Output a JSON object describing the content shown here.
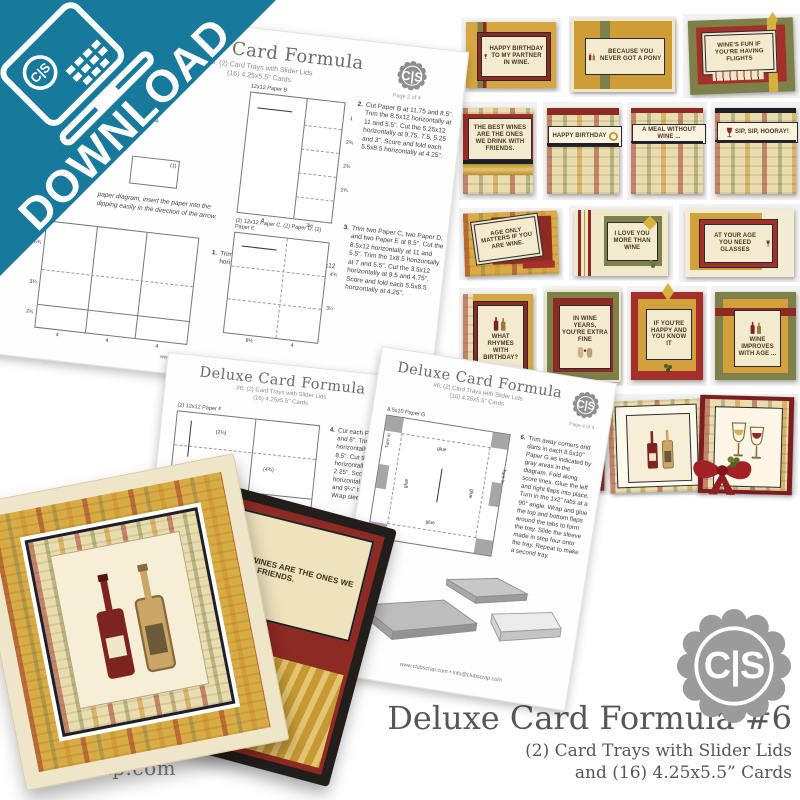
{
  "brand": {
    "badge_label": "C|S",
    "site": "clubscrap.com"
  },
  "banner": {
    "label": "DOWNLOAD"
  },
  "product": {
    "title": "Deluxe Card Formula #6",
    "subtitle_line1": "(2) Card Trays with Slider Lids",
    "subtitle_line2": "and (16) 4.25x5.5” Cards"
  },
  "colors": {
    "teal": "#17799C",
    "gold": "#D2A13C",
    "olive": "#7D8049",
    "dark_red": "#9C2D26",
    "cream": "#F2E8CB",
    "badge_gray": "#9B9B9B",
    "text_gray": "#58595B"
  },
  "icons": [
    "laptop-download-icon",
    "cs-seal-icon",
    "wine-glass-icon",
    "wine-bottles-icon",
    "gold-leaf-icon",
    "grapes-icon",
    "ribbon-bow-icon"
  ],
  "sheets": [
    {
      "title": "Deluxe Card Formula",
      "subtitle": "#6: (2) Card Trays with Slider Lids",
      "subtitle2": "(16) 4.25x5.5\" Cards",
      "page": "Page 2 of 4",
      "supplies_fragment1": "G.",
      "supplies_fragment2": ") A2 Envelopes.",
      "note_line1": "paper diagram, insert the paper into the",
      "note_line2": "dipping easily in the direction of the arrow.",
      "inset_label": "(1)",
      "diagrams": {
        "paper_a": {
          "left_ticks": [
            "5¾",
            "3¾",
            "2¾"
          ],
          "bottom_ticks": [
            "4",
            "4",
            "4"
          ]
        },
        "paper_b": {
          "label": "12x12 Paper B",
          "right_ticks": [
            "1",
            "2¾",
            "2¾",
            "2¾"
          ],
          "bottom_ticks": [
            "8",
            "3½"
          ]
        },
        "paper_cde": {
          "label": "(2) 12x12 Paper C, (2) Paper D, (2) Paper E",
          "right_ticks": [
            "4¾",
            "3¼"
          ],
          "bottom_ticks": [
            "8½",
            "4"
          ]
        }
      },
      "steps": [
        {
          "num": "1.",
          "text": "Trim Paper A at 8 and 4\". Cut each 4x12 horizontally at 10.5 and 5.25\"."
        },
        {
          "num": "2.",
          "text": "Cut Paper B at 11.75 and 8.5\". Trim the 8.5x12 horizontally at 11 and 5.5\". Cut the 5.25x12 horizontally at 9.75, 7.5, 5.25 and 3\". Score and fold each 5.5x8.5 horizontally at 4.25\"."
        },
        {
          "num": "3.",
          "text": "Trim two Paper C, two Paper D, and two Paper E at 8.5\". Cut the 8.5x12 horizontally at 11 and 5.5\". Trim the 1x8.5 horizontally at 7 and 5.5\". Cut the 3.5x12 horizontally at 9.5 and 4.75\". Score and fold each 5.5x8.5 horizontally at 4.25\"."
        }
      ],
      "footer": "www.clubscrap.com • info@clubscrap.com"
    },
    {
      "title": "Deluxe Card Formula",
      "subtitle": "#6: (2) Card Trays with Slider Lids",
      "subtitle2": "(16) 4.25x5.5\" Cards",
      "page": "Page 3 of 4",
      "diagrams": {
        "paper_f": {
          "label": "(2) 12x12 Paper F",
          "t1": "(2¾)",
          "t2": "(4¾)",
          "t3": "(8¼)",
          "t4": "12",
          "t5": "5¾",
          "t6": "3¼",
          "b1": "8",
          "b2": "2¾",
          "b3": "2½"
        },
        "paper_g": {
          "label": "(2) 12x12 Paper G",
          "t1": "(4½)"
        }
      },
      "steps": [
        {
          "num": "4.",
          "text": "Cut each Paper F at 11.5 and 6\". Trim the 5.5x12 horizontally at 11.75 and 8.5\". Cut the 3.25x5.5 horizontally at 4.5 and 2.25\". Score each 6x12 horizontally at 2¾, 3½, 8½ and 9¼\" to create a sleeve. Wrap sleeve around tray."
        },
        {
          "num": "5.",
          "text": "Cut each Paper G at 8.5\". Trim the 8.5x12 horizontally at 10\". Cut the 2x8.5 horizontally at 8 and 4\". Trim the 1x8.5 horizontally at 3, and 2.5\". Score the 8.5x10 at 2, 4.5 and 6\" horizontally."
        }
      ],
      "footer": "www.clubscrap.com • info@clubscrap.com"
    },
    {
      "title": "Deluxe Card Formula",
      "subtitle": "#6: (2) Card Trays with Slider Lids",
      "subtitle2": "(16) 4.25x5.5\" Cards",
      "page": "Page 4 of 4",
      "diagrams": {
        "paper_g10": {
          "label": "8.5x10 Paper G",
          "glue": "glue",
          "turn_in": "Turn in"
        }
      },
      "steps": [
        {
          "num": "6.",
          "text": "Trim away corners and darts in each 8.5x10\" Paper G as indicated by gray areas in the diagram. Fold along score lines. Glue the left and right flaps into place. Turn in the 1x2\" tabs at a 90° angle. Wrap and glue the top and bottom flaps around the tabs to form the tray. Slide the sleeve made in step four onto the tray. Repeat to make a second tray."
        }
      ],
      "footer": "www.clubscrap.com • info@clubscrap.com"
    }
  ],
  "card_grid": {
    "sentiments": [
      "HAPPY BIRTHDAY TO MY PARTNER IN WINE.",
      "BECAUSE YOU NEVER GOT A PONY",
      "WINE'S FUN IF YOU'RE HAVING FLIGHTS",
      "THE BEST WINES ARE THE ONES WE DRINK WITH FRIENDS.",
      "HAPPY BIRTHDAY",
      "A MEAL WITHOUT WINE ...",
      "SIP, SIP, HOORAY!",
      "AGE ONLY MATTERS IF YOU ARE WINE.",
      "I LOVE YOU MORE THAN WINE",
      "AT YOUR AGE YOU NEED GLASSES",
      "WHAT RHYMES WITH BIRTHDAY?",
      "IN WINE YEARS, YOU'RE EXTRA FINE",
      "IF YOU'RE HAPPY AND YOU KNOW IT",
      "WINE IMPROVES WITH AGE ...",
      "PEOPLE WHO SAY YOU'RE HARD TO SHOP FOR DON'T KNOW WHERE TO BUY WINE."
    ]
  },
  "tray_photo": {
    "card_text": "THE BEST WINES ARE THE ONES WE DRINK WITH FRIENDS."
  }
}
